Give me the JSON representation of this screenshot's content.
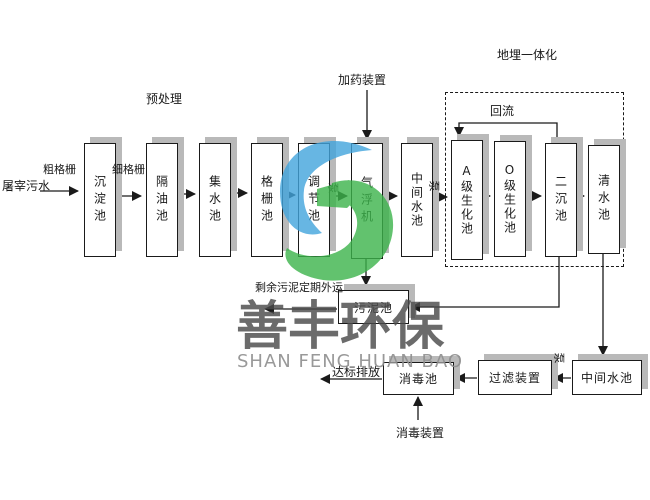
{
  "watermark": {
    "cn": "善丰环保",
    "en": "SHAN FENG HUAN BAO",
    "color_cn": "#4b4b4b",
    "color_en": "#8f8f8f",
    "logo_blue": "#42a5dd",
    "logo_green": "#3cb44b"
  },
  "stages": {
    "influent": "屠宰污水",
    "coarse_screen": "粗格栅",
    "fine_screen": "细格栅",
    "pretreatment": "预处理",
    "sedimentation": "沉淀池",
    "oil_separation": "隔油池",
    "collection": "集水池",
    "screen_tank": "格栅池",
    "regulating": "调节池",
    "pump": "泵",
    "air_flotation": "气浮机",
    "dosing_device": "加药装置",
    "intermediate_top": "中间水池",
    "a_bio": "A级生化池",
    "o_bio": "O级生化池",
    "secondary_sed": "二沉池",
    "clear_water": "清水池",
    "buried_integration": "地埋一体化",
    "reflux": "回流",
    "sludge": "污泥池",
    "sludge_out": "剩余污泥定期外运",
    "disinfection": "消毒池",
    "discharge": "达标排放",
    "disinfection_device": "消毒装置",
    "filter_device": "过滤装置",
    "intermediate_bottom": "中间水池"
  }
}
